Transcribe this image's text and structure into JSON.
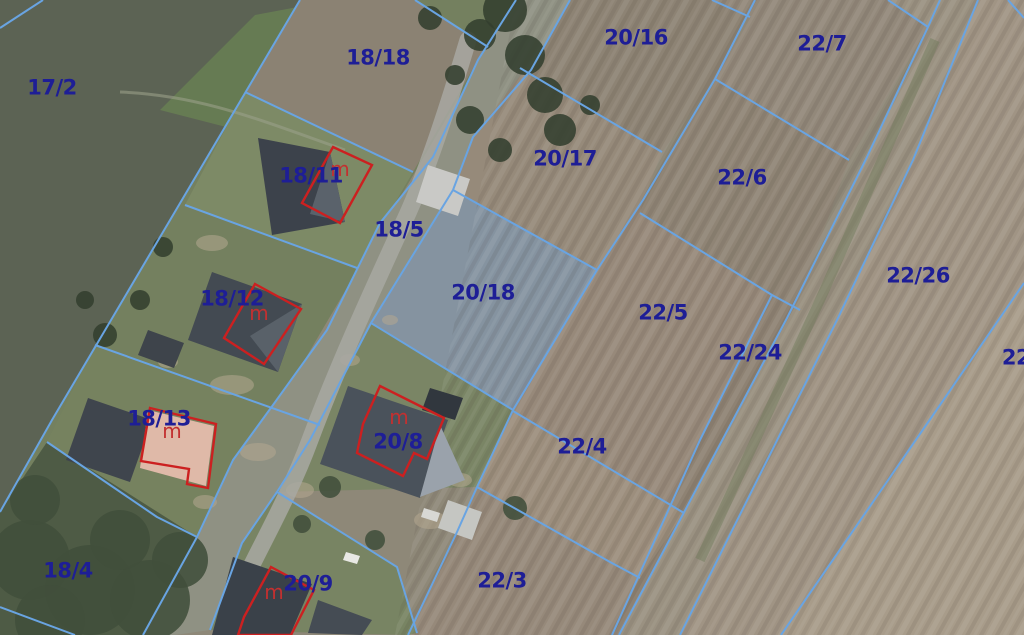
{
  "map": {
    "type": "cadastral-aerial-map",
    "canvas": {
      "width": 1024,
      "height": 635
    },
    "colors": {
      "base_field": "#8e8878",
      "boundary_line": "#69a4e2",
      "parcel_label": "#1e1e96",
      "building_outline": "#cc2020",
      "building_mark": "#c23030",
      "road": "#8f9183",
      "asphalt": "#a8a8a2",
      "selected_field": "#8593a0",
      "lawn": "#74805f",
      "dark_green_field": "#5c6354",
      "tree": "#333f2f",
      "tree_dark": "#414e3b"
    },
    "parcel_labels": [
      {
        "text": "17/2",
        "x": 52,
        "y": 87
      },
      {
        "text": "18/18",
        "x": 378,
        "y": 57
      },
      {
        "text": "20/16",
        "x": 636,
        "y": 37
      },
      {
        "text": "22/7",
        "x": 822,
        "y": 43
      },
      {
        "text": "18/11",
        "x": 311,
        "y": 175
      },
      {
        "text": "20/17",
        "x": 565,
        "y": 158
      },
      {
        "text": "22/6",
        "x": 742,
        "y": 177
      },
      {
        "text": "18/5",
        "x": 399,
        "y": 229
      },
      {
        "text": "22/26",
        "x": 918,
        "y": 275
      },
      {
        "text": "18/12",
        "x": 232,
        "y": 298
      },
      {
        "text": "20/18",
        "x": 483,
        "y": 292
      },
      {
        "text": "22/5",
        "x": 663,
        "y": 312
      },
      {
        "text": "22/24",
        "x": 750,
        "y": 352
      },
      {
        "text": "22",
        "x": 1016,
        "y": 357
      },
      {
        "text": "18/13",
        "x": 159,
        "y": 418
      },
      {
        "text": "20/8",
        "x": 398,
        "y": 441
      },
      {
        "text": "22/4",
        "x": 582,
        "y": 446
      },
      {
        "text": "18/4",
        "x": 68,
        "y": 570
      },
      {
        "text": "20/9",
        "x": 308,
        "y": 583
      },
      {
        "text": "22/3",
        "x": 502,
        "y": 580
      }
    ],
    "building_marks": [
      {
        "text": "m",
        "x": 340,
        "y": 176
      },
      {
        "text": "m",
        "x": 259,
        "y": 320
      },
      {
        "text": "m",
        "x": 172,
        "y": 438
      },
      {
        "text": "m",
        "x": 399,
        "y": 424
      },
      {
        "text": "m",
        "x": 274,
        "y": 599
      }
    ],
    "fields": [
      {
        "name": "corner-nw",
        "points": "0,0 43,0 0,28",
        "fill": "#4f574a"
      },
      {
        "name": "parcel-17-2",
        "points": "0,0 300,0 52,420 0,512",
        "fill": "#5c6354"
      },
      {
        "name": "crop-band-green",
        "points": "160,110 255,15 335,0 230,128",
        "fill": "#6f8f52",
        "opacity": 0.55
      },
      {
        "name": "yards-strip",
        "points": "300,0 516,0 143,635 0,635 0,512 52,420",
        "fill": "#74805f"
      },
      {
        "name": "parcel-18-18",
        "points": "300,0 415,0 488,47 478,60 413,172 245,92",
        "fill": "#8b8273"
      },
      {
        "name": "yard-18-11",
        "points": "245,92 413,172 357,268 185,205",
        "fill": "#7d8a66"
      },
      {
        "name": "yard-18-13",
        "points": "95,345 320,425 197,537 47,442",
        "fill": "#76825f"
      },
      {
        "name": "parcel-18-4",
        "points": "47,442 197,537 143,635 0,635 0,512",
        "fill": "#4e5b45"
      },
      {
        "name": "road-corridor",
        "points": "516,0 570,0 531,70 473,137 453,190 371,323 310,440 277,492 242,543 210,630 175,635 143,635 197,537 233,460 273,405 327,330 380,223 433,157 478,60",
        "fill": "#8f9183"
      },
      {
        "name": "parcel-20-16",
        "points": "570,0 755,0 715,79 662,152 520,68 531,70",
        "fill": "#8d8374"
      },
      {
        "name": "parcel-20-17",
        "points": "523,72 662,152 643,200 597,270 453,190 473,137",
        "fill": "#968a7a"
      },
      {
        "name": "parcel-20-18",
        "points": "453,190 597,270 513,410 371,323",
        "fill": "#8593a0"
      },
      {
        "name": "parcel-22-7",
        "points": "712,0 888,0 928,27 849,160 715,79 750,17",
        "fill": "#92887a"
      },
      {
        "name": "parcel-22-6",
        "points": "715,79 849,160 795,310 640,213 643,200",
        "fill": "#8f8475"
      },
      {
        "name": "parcel-22-5",
        "points": "640,213 772,295 700,440 612,635 408,635 457,532 477,487 513,410 597,270 643,200",
        "fill": "#97897a"
      },
      {
        "name": "parcel-22-24",
        "points": "772,295 795,310 787,318 619,635 612,635 700,440",
        "fill": "#8e8273"
      },
      {
        "name": "parcel-22-4",
        "points": "513,411 684,513 640,578 610,562 477,487",
        "fill": "#9c8e7d"
      },
      {
        "name": "parcel-22-3",
        "points": "477,487 610,562 640,578 612,635 408,635 457,532",
        "fill": "#96897a"
      },
      {
        "name": "track-strip",
        "points": "888,0 978,0 913,160 838,318 680,635 619,635 787,318 867,157 928,27",
        "fill": "#9a9181"
      },
      {
        "name": "parcel-22-26",
        "points": "978,0 1024,0 1024,283 940,405 781,635 680,635 838,318 913,160",
        "fill": "#a09484"
      },
      {
        "name": "parcel-22-se",
        "points": "1024,283 1024,635 781,635 940,405",
        "fill": "#a89c8a"
      },
      {
        "name": "yard-20-8",
        "points": "371,323 513,410 477,487 277,492 310,440",
        "fill": "#7a8565"
      },
      {
        "name": "yard-20-9",
        "points": "277,492 397,567 417,633 408,635 210,630 242,543",
        "fill": "#788463"
      }
    ],
    "textures": {
      "plow_stripes_angle": 29,
      "stripe_area_points": "516,0 1024,0 1024,635 395,635",
      "track_green_line": "935,40 820,300 700,560"
    },
    "dirt_patches": [
      {
        "x": 212,
        "y": 243,
        "rx": 16,
        "ry": 8
      },
      {
        "x": 247,
        "y": 306,
        "rx": 10,
        "ry": 6
      },
      {
        "x": 232,
        "y": 385,
        "rx": 22,
        "ry": 10
      },
      {
        "x": 258,
        "y": 452,
        "rx": 18,
        "ry": 9
      },
      {
        "x": 300,
        "y": 490,
        "rx": 14,
        "ry": 8
      },
      {
        "x": 205,
        "y": 502,
        "rx": 12,
        "ry": 7
      },
      {
        "x": 430,
        "y": 520,
        "rx": 16,
        "ry": 9
      },
      {
        "x": 460,
        "y": 480,
        "rx": 12,
        "ry": 7
      },
      {
        "x": 350,
        "y": 360,
        "rx": 10,
        "ry": 6
      },
      {
        "x": 390,
        "y": 320,
        "rx": 8,
        "ry": 5
      },
      {
        "x": 168,
        "y": 362,
        "rx": 10,
        "ry": 6
      }
    ],
    "trees": [
      {
        "x": 505,
        "y": 10,
        "r": 22
      },
      {
        "x": 525,
        "y": 55,
        "r": 20
      },
      {
        "x": 545,
        "y": 95,
        "r": 18
      },
      {
        "x": 560,
        "y": 130,
        "r": 16
      },
      {
        "x": 480,
        "y": 35,
        "r": 16
      },
      {
        "x": 470,
        "y": 120,
        "r": 14
      },
      {
        "x": 500,
        "y": 150,
        "r": 12
      },
      {
        "x": 590,
        "y": 105,
        "r": 10
      },
      {
        "x": 430,
        "y": 18,
        "r": 12
      },
      {
        "x": 455,
        "y": 75,
        "r": 10
      },
      {
        "x": 30,
        "y": 560,
        "r": 40
      },
      {
        "x": 90,
        "y": 590,
        "r": 45
      },
      {
        "x": 150,
        "y": 600,
        "r": 40
      },
      {
        "x": 50,
        "y": 620,
        "r": 35
      },
      {
        "x": 120,
        "y": 540,
        "r": 30
      },
      {
        "x": 180,
        "y": 560,
        "r": 28
      },
      {
        "x": 35,
        "y": 500,
        "r": 25
      },
      {
        "x": 515,
        "y": 508,
        "r": 12
      },
      {
        "x": 330,
        "y": 487,
        "r": 11
      },
      {
        "x": 302,
        "y": 524,
        "r": 9
      },
      {
        "x": 375,
        "y": 540,
        "r": 10
      },
      {
        "x": 105,
        "y": 335,
        "r": 12
      },
      {
        "x": 140,
        "y": 300,
        "r": 10
      },
      {
        "x": 85,
        "y": 300,
        "r": 9
      },
      {
        "x": 163,
        "y": 247,
        "r": 10
      }
    ],
    "houses": [
      {
        "name": "house-18-11-roof",
        "points": "258,138 330,152 345,222 272,235",
        "fill": "#3c424b"
      },
      {
        "name": "house-18-11-face",
        "points": "330,152 345,222 310,214",
        "fill": "#5a626b"
      },
      {
        "name": "outbuilding-18-5",
        "points": "428,165 470,179 458,216 416,202",
        "fill": "#c9c9c6"
      },
      {
        "name": "house-18-12-roof",
        "points": "212,272 302,304 278,372 188,340",
        "fill": "#434a52"
      },
      {
        "name": "house-18-12-face",
        "points": "302,304 278,372 250,336",
        "fill": "#596169"
      },
      {
        "name": "shed-18-12",
        "points": "148,330 184,343 174,368 138,355",
        "fill": "#3e444b"
      },
      {
        "name": "house-18-13-dark",
        "points": "88,398 152,420 130,482 66,460",
        "fill": "#3f454d"
      },
      {
        "name": "house-18-13-salmon",
        "points": "148,410 214,426 206,486 140,468",
        "fill": "#dfb9a8"
      },
      {
        "name": "garage-20-8",
        "points": "430,388 463,398 455,420 422,410",
        "fill": "#31373e"
      },
      {
        "name": "house-20-8-roof",
        "points": "348,386 448,420 420,498 320,464",
        "fill": "#4a525b"
      },
      {
        "name": "house-20-8-face",
        "points": "440,425 465,480 420,497",
        "fill": "#9aa2ab"
      },
      {
        "name": "barn-white",
        "points": "448,500 482,512 472,540 438,528",
        "fill": "#c5c6c2"
      },
      {
        "name": "house-20-9-roof",
        "points": "233,557 312,584 290,635 212,635",
        "fill": "#3a4149"
      },
      {
        "name": "house-bottom",
        "points": "318,600 372,620 362,635 308,633",
        "fill": "#454c54"
      },
      {
        "name": "car-white",
        "points": "346,552 360,556 357,564 343,560",
        "fill": "#e8e8e4"
      },
      {
        "name": "cargo-white",
        "points": "424,508 440,513 437,522 421,517",
        "fill": "#d8d8d4"
      }
    ],
    "road_path": "M 468,40 C 450,100 425,180 400,230 C 375,285 340,360 310,440 C 288,500 255,555 235,600",
    "field_track_path": "M 120,92 C 200,95 260,120 345,150",
    "boundary_lines": [
      {
        "name": "corner-nw-line",
        "points": "0,28 43,0"
      },
      {
        "name": "line-17-2-east",
        "points": "300,0 52,420 0,512"
      },
      {
        "name": "road-west",
        "points": "516,0 478,60 433,157 380,223 327,330 273,405 233,460 197,537 143,635"
      },
      {
        "name": "road-east",
        "points": "570,0 531,70 473,137 453,190 371,323 310,440 277,492 242,543 210,630"
      },
      {
        "name": "strip-a",
        "points": "755,0 715,79 643,200 597,270 513,410 477,487 457,532 408,635"
      },
      {
        "name": "strip-b",
        "points": "940,0 928,27 867,157 787,318 619,635"
      },
      {
        "name": "strip-c",
        "points": "978,0 913,160 838,318 680,635"
      },
      {
        "name": "strip-d",
        "points": "1024,283 940,405 781,635"
      },
      {
        "name": "strip-mid",
        "points": "772,295 700,440 612,635"
      },
      {
        "name": "cross-18-18-north",
        "points": "415,0 488,47"
      },
      {
        "name": "cross-18-18-south",
        "points": "245,92 413,172"
      },
      {
        "name": "cross-18-11-south",
        "points": "185,205 357,268"
      },
      {
        "name": "cross-18-12-south",
        "points": "95,345 320,425"
      },
      {
        "name": "cross-18-13-south",
        "points": "47,442 157,517 197,537"
      },
      {
        "name": "cross-top-wedge",
        "points": "712,0 750,17"
      },
      {
        "name": "cross-20-16-south",
        "points": "520,68 662,152"
      },
      {
        "name": "cross-22-7-south",
        "points": "715,79 849,160"
      },
      {
        "name": "cross-22-6-south",
        "points": "640,213 772,295 800,310"
      },
      {
        "name": "cross-22-5-south",
        "points": "513,411 684,513"
      },
      {
        "name": "cross-22-4-south",
        "points": "477,487 610,562 640,578"
      },
      {
        "name": "parcel-20-18-ne",
        "points": "453,190 597,270"
      },
      {
        "name": "parcel-20-18-sw",
        "points": "371,323 513,410"
      },
      {
        "name": "cross-20-9-north",
        "points": "277,492 397,567 417,633"
      },
      {
        "name": "cross-22-7-ne",
        "points": "888,0 928,27"
      },
      {
        "name": "corner-ne-line",
        "points": "1008,0 1024,18"
      },
      {
        "name": "corner-sw-line",
        "points": "0,607 75,635"
      }
    ],
    "building_outlines": [
      {
        "name": "outline-18-11",
        "points": "333,147 372,165 340,223 302,203"
      },
      {
        "name": "outline-18-12",
        "points": "255,284 301,309 264,364 224,338"
      },
      {
        "name": "outline-18-13",
        "points": "150,408 216,424 208,488 187,484 189,469 141,461"
      },
      {
        "name": "outline-20-8",
        "points": "380,386 444,418 427,459 414,453 403,476 357,453 363,424"
      },
      {
        "name": "outline-20-9",
        "points": "271,567 314,590 291,635 238,635 244,617"
      }
    ],
    "label_font_px": 21,
    "mark_font_px": 20
  }
}
